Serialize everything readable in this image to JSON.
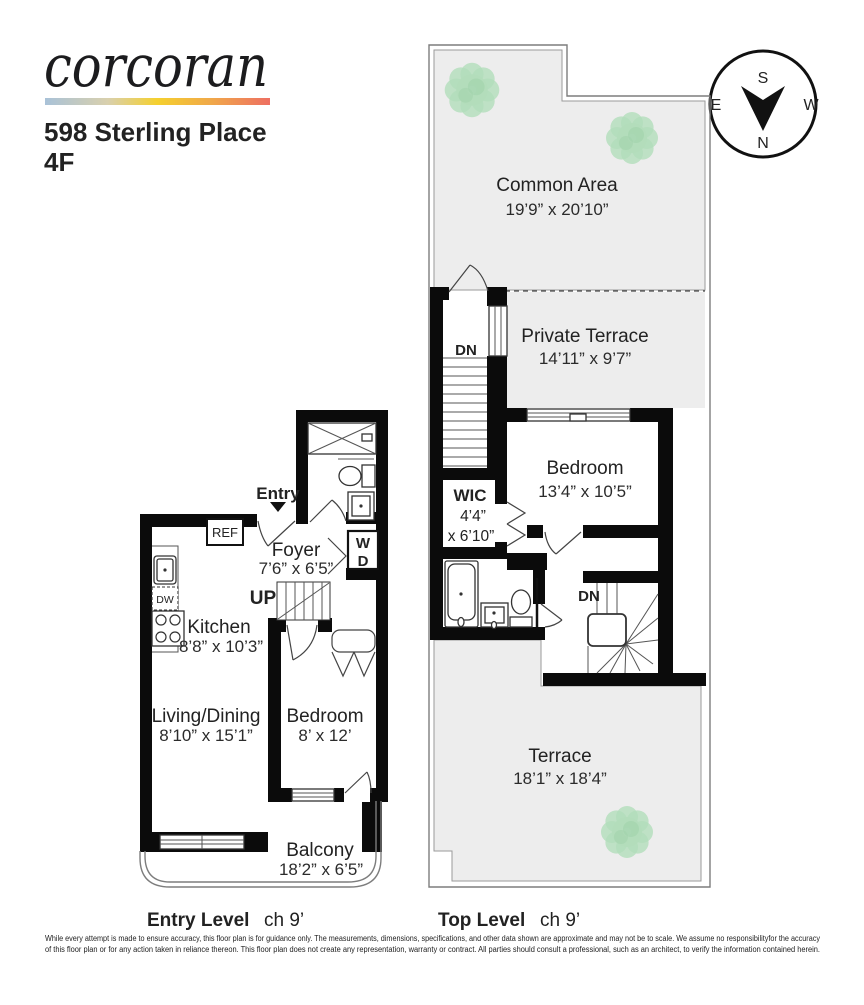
{
  "header": {
    "logo_text": "corcoran",
    "address_line1": "598 Sterling Place",
    "address_line2": "4F"
  },
  "compass": {
    "north": "N",
    "south": "S",
    "east": "E",
    "west": "W"
  },
  "entry_level": {
    "caption": {
      "title": "Entry Level",
      "ceiling": "ch 9’"
    },
    "labels": {
      "entry": "Entry",
      "ref": "REF",
      "up": "UP",
      "dw": "DW",
      "washer": "W",
      "dryer": "D"
    },
    "rooms": {
      "foyer": {
        "name": "Foyer",
        "dims": "7’6” x 6’5”"
      },
      "kitchen": {
        "name": "Kitchen",
        "dims": "8’8” x 10’3”"
      },
      "living_dining": {
        "name": "Living/Dining",
        "dims": "8’10” x 15’1”"
      },
      "bedroom": {
        "name": "Bedroom",
        "dims": "8’ x 12’"
      },
      "balcony": {
        "name": "Balcony",
        "dims": "18’2” x 6’5”"
      }
    }
  },
  "top_level": {
    "caption": {
      "title": "Top Level",
      "ceiling": "ch 9’"
    },
    "labels": {
      "down_upper": "DN",
      "down_lower": "DN"
    },
    "rooms": {
      "common_area": {
        "name": "Common Area",
        "dims": "19’9” x 20’10”"
      },
      "private_terrace": {
        "name": "Private Terrace",
        "dims": "14’11” x 9’7”"
      },
      "bedroom": {
        "name": "Bedroom",
        "dims": "13’4” x 10’5”"
      },
      "wic": {
        "name": "WIC",
        "dims_line1": "4’4”",
        "dims_line2": "x 6’10”"
      },
      "terrace": {
        "name": "Terrace",
        "dims": "18’1” x 18’4”"
      }
    }
  },
  "disclaimer": {
    "line1": "While every attempt is made to ensure accuracy, this floor plan is for guidance only. The measurements, dimensions, specifications, and other data shown are approximate and may not be to scale. We assume no responsibilityfor the accuracy",
    "line2": "of this floor plan or for any action taken in reliance thereon. This floor plan does not create any representation, warranty or contract. All parties should consult a professional, such as an architect, to verify the information contained herein."
  },
  "colors": {
    "wall": "#0b0b0b",
    "terrace_fill": "#ededed",
    "plant_green": "#b2ddba",
    "brand_gradient_left": "#a9c2d8",
    "brand_gradient_mid": "#f5d02e",
    "brand_gradient_right": "#ee6f62",
    "label_text": "#222222"
  }
}
